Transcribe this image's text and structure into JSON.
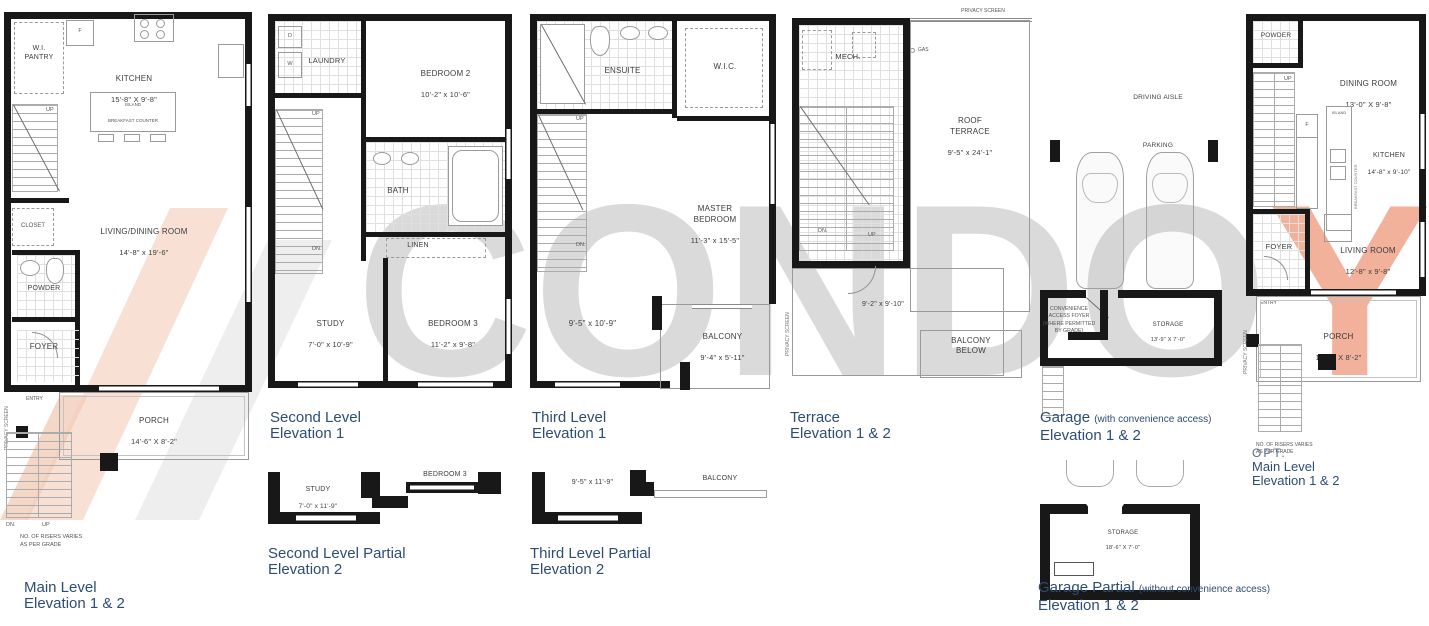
{
  "watermark": {
    "gray_text": "CONDO",
    "accent_text": "Y",
    "gray_color": "#dadada",
    "accent_color": "#f2b19b",
    "logo_salmon": "#f7dbcc",
    "logo_gray": "#ececec"
  },
  "title_color": "#2d4d74",
  "plans": {
    "main_level": {
      "title1": "Main Level",
      "title2": "Elevation 1 & 2",
      "rooms": {
        "wi_pantry": "W.I.\nPANTRY",
        "fridge": "F",
        "kitchen": "KITCHEN",
        "kitchen_dim": "15'-8\" X 9'-8\"",
        "island": "ISLAND",
        "breakfast_counter": "BREAKFAST COUNTER",
        "closet": "CLOSET",
        "living_dining": "LIVING/DINING ROOM",
        "living_dining_dim": "14'-8\" x 19'-6\"",
        "powder": "POWDER",
        "foyer": "FOYER",
        "entry": "ENTRY",
        "porch": "PORCH",
        "porch_dim": "14'-6\" X 8'-2\"",
        "up": "UP",
        "dn": "DN.",
        "privacy_screen": "PRIVACY SCREEN",
        "risers_note": "NO. OF RISERS VARIES\nAS PER GRADE"
      }
    },
    "second_level": {
      "title1": "Second Level",
      "title2": "Elevation 1",
      "rooms": {
        "dryer": "D",
        "washer": "W",
        "laundry": "LAUNDRY",
        "bedroom2": "BEDROOM 2",
        "bedroom2_dim": "10'-2\" x 10'-6\"",
        "bath": "BATH",
        "linen": "LINEN",
        "study": "STUDY",
        "study_dim": "7'-0\" x 10'-9\"",
        "bedroom3": "BEDROOM 3",
        "bedroom3_dim": "11'-2\" x 9'-8\"",
        "up": "UP",
        "dn": "DN."
      }
    },
    "third_level": {
      "title1": "Third Level",
      "title2": "Elevation 1",
      "rooms": {
        "ensuite": "ENSUITE",
        "wic": "W.I.C.",
        "master": "MASTER\nBEDROOM",
        "master_dim": "11'-3\" x 15'-5\"",
        "open_dim": "9'-5\" x 10'-9\"",
        "balcony": "BALCONY",
        "balcony_dim": "9'-4\" x 5'-11\"",
        "up": "UP",
        "dn": "DN."
      }
    },
    "terrace": {
      "title1": "Terrace",
      "title2": "Elevation 1 & 2",
      "rooms": {
        "privacy_screen_top": "PRIVACY SCREEN",
        "privacy_screen_left": "PRIVACY SCREEN",
        "mech": "MECH.",
        "gas": "GAS",
        "roof_terrace": "ROOF\nTERRACE",
        "roof_terrace_dim": "9'-5\" x 24'-1\"",
        "terrace_dim": "9'-2\" x 9'-10\"",
        "balcony_below": "BALCONY\nBELOW",
        "up": "UP",
        "dn": "DN."
      }
    },
    "garage": {
      "title1": "Garage",
      "title1_note": "(with convenience access)",
      "title2": "Elevation 1 & 2",
      "rooms": {
        "driving_aisle": "DRIVING AISLE",
        "parking": "PARKING",
        "conv_foyer": "CONVENIENCE\nACCESS FOYER\n(WHERE PERMITTED\nBY GRADE)",
        "storage": "STORAGE",
        "storage_dim": "13'-9\" X 7'-0\""
      }
    },
    "opt_main_level": {
      "title0": "OPT.",
      "title1": "Main Level",
      "title2": "Elevation 1 & 2",
      "rooms": {
        "powder": "POWDER",
        "dining": "DINING ROOM",
        "dining_dim": "13'-0\" X 9'-8\"",
        "fridge": "F",
        "island": "ISLAND",
        "breakfast_counter": "BREAKFAST COUNTER",
        "kitchen": "KITCHEN",
        "kitchen_dim": "14'-8\" x 9'-10\"",
        "foyer": "FOYER",
        "living": "LIVING ROOM",
        "living_dim": "12'-8\" x 9'-8\"",
        "entry": "ENTRY",
        "porch": "PORCH",
        "porch_dim": "14'-6\" X 8'-2\"",
        "up": "UP",
        "privacy_screen": "PRIVACY SCREEN",
        "risers_note": "NO. OF RISERS VARIES\nAS PER GRADE"
      }
    },
    "second_partial": {
      "title1": "Second Level Partial",
      "title2": "Elevation 2",
      "rooms": {
        "study": "STUDY",
        "study_dim": "7'-0\" x 11'-9\"",
        "bedroom3": "BEDROOM 3"
      }
    },
    "third_partial": {
      "title1": "Third Level Partial",
      "title2": "Elevation 2",
      "rooms": {
        "dim": "9'-5\" x 11'-9\"",
        "balcony": "BALCONY"
      }
    },
    "garage_partial": {
      "title1": "Garage Partial",
      "title1_note": "(without convenience access)",
      "title2": "Elevation 1 & 2",
      "rooms": {
        "storage": "STORAGE",
        "storage_dim": "18'-6\" X 7'-0\""
      }
    }
  }
}
